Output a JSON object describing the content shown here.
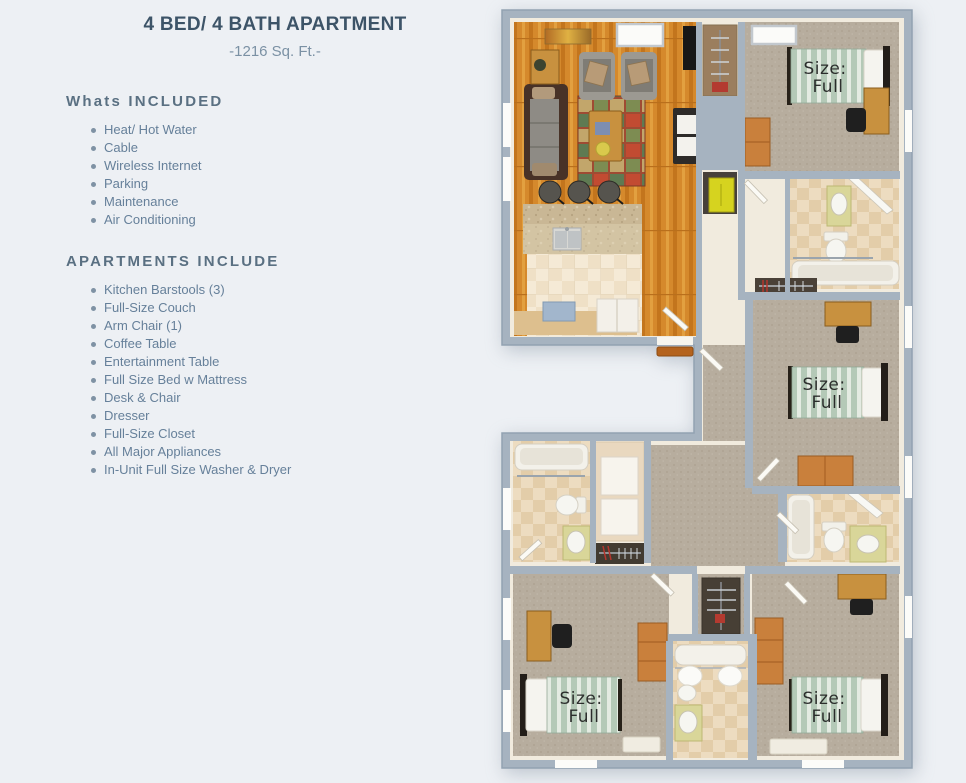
{
  "header": {
    "title": "4 BED/ 4 BATH APARTMENT",
    "subtitle": "-1216 Sq. Ft.-"
  },
  "included": {
    "heading": "Whats INCLUDED",
    "items": [
      "Heat/ Hot Water",
      "Cable",
      "Wireless Internet",
      "Parking",
      "Maintenance",
      "Air Conditioning"
    ]
  },
  "apartments": {
    "heading": "APARTMENTS INCLUDE",
    "items": [
      "Kitchen Barstools (3)",
      "Full-Size Couch",
      "Arm Chair (1)",
      "Coffee Table",
      "Entertainment Table",
      "Full Size Bed w Mattress",
      "Desk & Chair",
      "Dresser",
      "Full-Size Closet",
      "All Major Appliances",
      "In-Unit Full Size Washer & Dryer"
    ]
  },
  "floorplan": {
    "bed_count": 4,
    "bed_label": {
      "line1": "Size:",
      "line2": "Full"
    },
    "colors": {
      "wall_gray": "#a6b3c0",
      "inner_wall_cream": "#f1ebde",
      "wood_floor": "#d5892c",
      "carpet": "#b7ad9e",
      "accent_title": "#3d5468",
      "dresser_orange": "#c9803c"
    }
  }
}
